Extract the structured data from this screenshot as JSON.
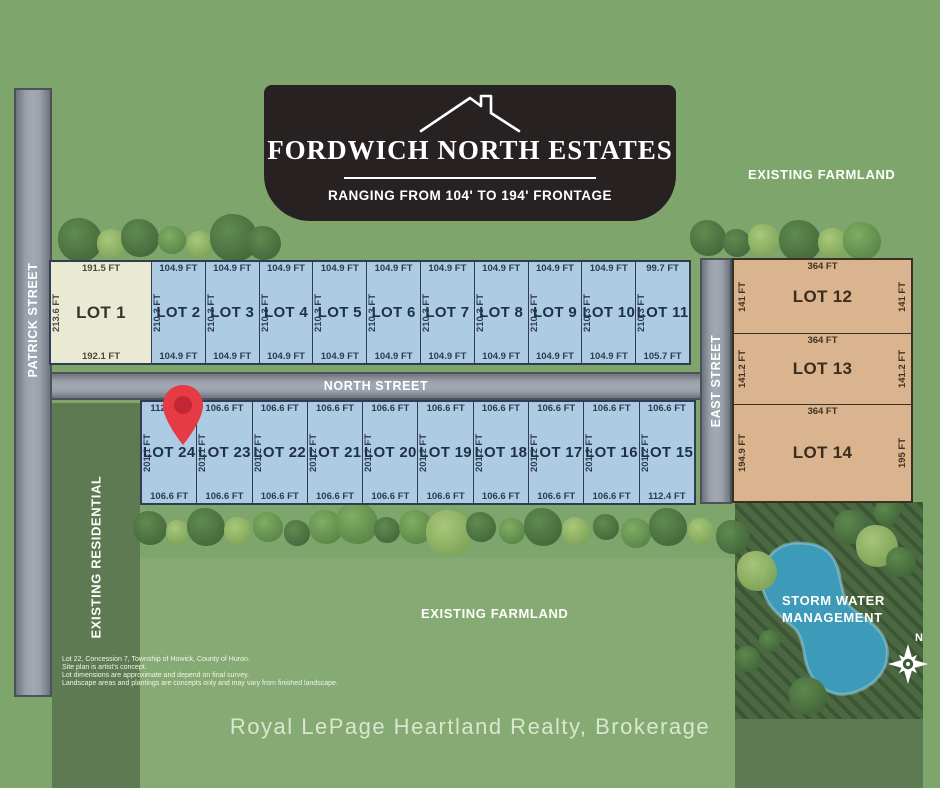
{
  "banner": {
    "title": "FORDWICH NORTH ESTATES",
    "subtitle": "RANGING FROM 104' TO 194' FRONTAGE"
  },
  "streets": {
    "patrick": "PATRICK STREET",
    "north": "NORTH STREET",
    "east": "EAST STREET"
  },
  "areas": {
    "existing_farmland_top": "EXISTING FARMLAND",
    "existing_farmland_bottom": "EXISTING FARMLAND",
    "existing_residential": "EXISTING RESIDENTIAL",
    "storm_water_line1": "STORM WATER",
    "storm_water_line2": "MANAGEMENT",
    "compass_north": "N"
  },
  "lots": {
    "top_row": [
      {
        "name": "LOT 1",
        "top": "191.5 FT",
        "side": "213.6 FT",
        "bottom": "192.1 FT",
        "variant": "beige"
      },
      {
        "name": "LOT 2",
        "top": "104.9 FT",
        "side": "210.3 FT",
        "bottom": "104.9 FT",
        "variant": "blue"
      },
      {
        "name": "LOT 3",
        "top": "104.9 FT",
        "side": "210.3 FT",
        "bottom": "104.9 FT",
        "variant": "blue"
      },
      {
        "name": "LOT 4",
        "top": "104.9 FT",
        "side": "210.3 FT",
        "bottom": "104.9 FT",
        "variant": "blue"
      },
      {
        "name": "LOT 5",
        "top": "104.9 FT",
        "side": "210.3 FT",
        "bottom": "104.9 FT",
        "variant": "blue"
      },
      {
        "name": "LOT 6",
        "top": "104.9 FT",
        "side": "210.3 FT",
        "bottom": "104.9 FT",
        "variant": "blue"
      },
      {
        "name": "LOT 7",
        "top": "104.9 FT",
        "side": "210.3 FT",
        "bottom": "104.9 FT",
        "variant": "blue"
      },
      {
        "name": "LOT 8",
        "top": "104.9 FT",
        "side": "210.3 FT",
        "bottom": "104.9 FT",
        "variant": "blue"
      },
      {
        "name": "LOT 9",
        "top": "104.9 FT",
        "side": "210.3 FT",
        "bottom": "104.9 FT",
        "variant": "blue"
      },
      {
        "name": "LOT 10",
        "top": "104.9 FT",
        "side": "210.3 FT",
        "bottom": "104.9 FT",
        "variant": "blue"
      },
      {
        "name": "LOT 11",
        "top": "99.7 FT",
        "side": "210.3 FT",
        "bottom": "105.7 FT",
        "variant": "blue"
      }
    ],
    "bottom_row": [
      {
        "name": "LOT 24",
        "top": "112.9 FT",
        "side": "201.1 FT",
        "bottom": "106.6 FT",
        "variant": "blue"
      },
      {
        "name": "LOT 23",
        "top": "106.6 FT",
        "side": "201.1 FT",
        "bottom": "106.6 FT",
        "variant": "blue"
      },
      {
        "name": "LOT 22",
        "top": "106.6 FT",
        "side": "201.2 FT",
        "bottom": "106.6 FT",
        "variant": "blue"
      },
      {
        "name": "LOT 21",
        "top": "106.6 FT",
        "side": "201.2 FT",
        "bottom": "106.6 FT",
        "variant": "blue"
      },
      {
        "name": "LOT 20",
        "top": "106.6 FT",
        "side": "201.2 FT",
        "bottom": "106.6 FT",
        "variant": "blue"
      },
      {
        "name": "LOT 19",
        "top": "106.6 FT",
        "side": "201.2 FT",
        "bottom": "106.6 FT",
        "variant": "blue"
      },
      {
        "name": "LOT 18",
        "top": "106.6 FT",
        "side": "201.2 FT",
        "bottom": "106.6 FT",
        "variant": "blue"
      },
      {
        "name": "LOT 17",
        "top": "106.6 FT",
        "side": "201.2 FT",
        "bottom": "106.6 FT",
        "variant": "blue"
      },
      {
        "name": "LOT 16",
        "top": "106.6 FT",
        "side": "201.2 FT",
        "bottom": "106.6 FT",
        "variant": "blue"
      },
      {
        "name": "LOT 15",
        "top": "106.6 FT",
        "side": "201.2 FT",
        "bottom": "112.4 FT",
        "variant": "blue"
      }
    ],
    "east_row": [
      {
        "name": "LOT 12",
        "top": "364 FT",
        "left": "141 FT",
        "right": "141 FT",
        "variant": "tan"
      },
      {
        "name": "LOT 13",
        "top": "364 FT",
        "left": "141.2 FT",
        "right": "141.2 FT",
        "variant": "tan"
      },
      {
        "name": "LOT 14",
        "top": "364 FT",
        "left": "194.9 FT",
        "right": "195 FT",
        "variant": "tan"
      }
    ]
  },
  "disclaimer": [
    "Lot 22, Concession 7, Township of Howick, County of Huron.",
    "Site plan is artist's concept.",
    "Lot dimensions are approximate and depend on final survey.",
    "Landscape areas and plantings are concepts only and may vary from finished landscape."
  ],
  "footer": "Royal LePage Heartland Realty, Brokerage",
  "colors": {
    "background_green": "#7EA56C",
    "dark_green_zone": "#5D7A52",
    "road_gray": "#99A0AA",
    "blue_lot": "#AECBE4",
    "beige_lot": "#EAE9D3",
    "tan_lot": "#D9B48F",
    "banner_black": "#272121",
    "pin_red": "#E63A44",
    "pond_blue": "#3D9AB9"
  }
}
